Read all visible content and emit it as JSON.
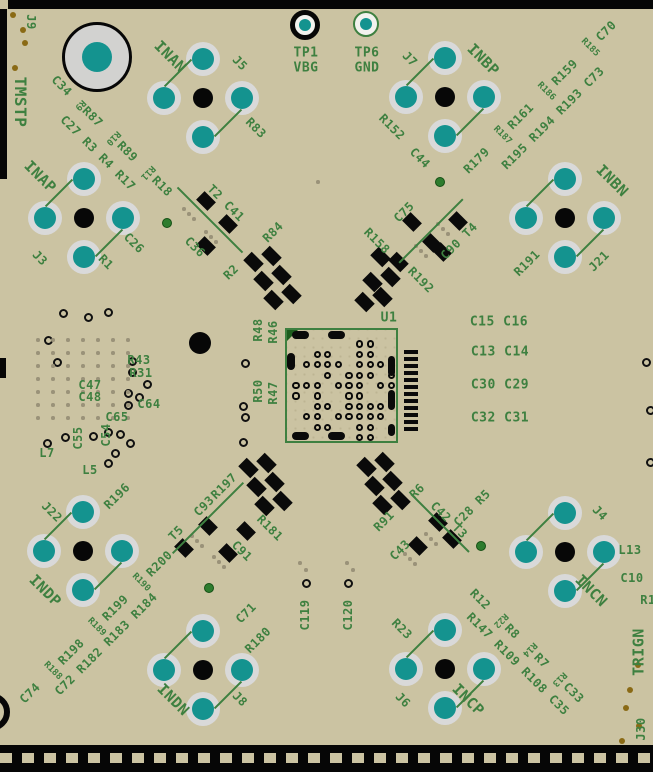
{
  "view": {
    "width": 653,
    "height": 772,
    "description": "PCB layout top view"
  },
  "colors": {
    "board_tan": "#cbc3a2",
    "silkscreen_green": "#3e8040",
    "pad_teal": "#14938f",
    "pad_ring_gray": "#d9d9d9",
    "background_black": "#060606",
    "gold_dot": "#8a6a15",
    "via_green": "#2e7c2e"
  },
  "big_pad": {
    "label": "1",
    "cx": 97,
    "cy": 57,
    "r": 35
  },
  "testpoints": [
    {
      "name": "TP1",
      "net": "VBG",
      "cx": 305,
      "cy": 25,
      "ring_color": "#070707",
      "ring_w": 5,
      "r": 15
    },
    {
      "name": "TP6",
      "net": "GND",
      "cx": 366,
      "cy": 24,
      "ring_color": "#3e8040",
      "ring_w": 2,
      "r": 13
    }
  ],
  "connectors": [
    {
      "net": "INAN",
      "refdes": "J5",
      "cx": 203,
      "cy": 98
    },
    {
      "net": "INBP",
      "refdes": "J7",
      "cx": 445,
      "cy": 97
    },
    {
      "net": "INAP",
      "refdes": "J3",
      "cx": 84,
      "cy": 218
    },
    {
      "net": "INBN",
      "refdes": "J21",
      "cx": 565,
      "cy": 218
    },
    {
      "net": "INDP",
      "refdes": "J22",
      "cx": 83,
      "cy": 551
    },
    {
      "net": "INDN",
      "refdes": "J8",
      "cx": 203,
      "cy": 670
    },
    {
      "net": "INCN",
      "refdes": "J4",
      "cx": 565,
      "cy": 552
    },
    {
      "net": "INCP",
      "refdes": "J6",
      "cx": 445,
      "cy": 669
    }
  ],
  "chip": {
    "refdes": "U1",
    "x": 285,
    "y": 328,
    "w": 113,
    "h": 115,
    "bga_rows": [
      "......OO..",
      "..OO..OO..",
      ".OOOO.OOO.",
      "...O.OOO.O",
      "OOO.OOO.OO",
      "O.O..OO..O",
      "..OO.OOOO.",
      ".OO.OOOOO.",
      "..OO..OO..",
      "......OO.."
    ],
    "bga_x0": 296,
    "bga_y0": 344,
    "bga_dx": 10.6,
    "bga_dy": 10.4
  },
  "ovals": [
    [
      300,
      335,
      17,
      8
    ],
    [
      336,
      335,
      17,
      8
    ],
    [
      300,
      436,
      17,
      8
    ],
    [
      336,
      436,
      17,
      8
    ],
    [
      291,
      361,
      8,
      17
    ],
    [
      391,
      366,
      7,
      20
    ],
    [
      391,
      400,
      7,
      20
    ],
    [
      391,
      430,
      7,
      12
    ]
  ],
  "bars": {
    "x": 404,
    "y0": 350,
    "count": 12,
    "step": 7,
    "w": 14,
    "h": 4
  },
  "labels": [
    {
      "t": "J9",
      "x": 31,
      "y": 22,
      "r": 90,
      "s": 12
    },
    {
      "t": "TMSTP",
      "x": 20,
      "y": 102,
      "r": 90,
      "s": 16
    },
    {
      "t": "TP1",
      "x": 306,
      "y": 53,
      "r": 0,
      "s": 13
    },
    {
      "t": "VBG",
      "x": 306,
      "y": 68,
      "r": 0,
      "s": 13
    },
    {
      "t": "TP6",
      "x": 367,
      "y": 53,
      "r": 0,
      "s": 13
    },
    {
      "t": "GND",
      "x": 367,
      "y": 68,
      "r": 0,
      "s": 13
    },
    {
      "t": "INAN",
      "x": 170,
      "y": 57,
      "r": 45,
      "s": 15
    },
    {
      "t": "J5",
      "x": 240,
      "y": 63,
      "r": 45,
      "s": 12
    },
    {
      "t": "R83",
      "x": 256,
      "y": 128,
      "r": 45,
      "s": 12
    },
    {
      "t": "J7",
      "x": 410,
      "y": 59,
      "r": 45,
      "s": 12
    },
    {
      "t": "INBP",
      "x": 483,
      "y": 60,
      "r": 45,
      "s": 15
    },
    {
      "t": "R152",
      "x": 392,
      "y": 127,
      "r": 45,
      "s": 12
    },
    {
      "t": "C44",
      "x": 420,
      "y": 158,
      "r": 45,
      "s": 12
    },
    {
      "t": "INAP",
      "x": 40,
      "y": 177,
      "r": 45,
      "s": 15
    },
    {
      "t": "J3",
      "x": 40,
      "y": 258,
      "r": 45,
      "s": 12
    },
    {
      "t": "R1",
      "x": 106,
      "y": 262,
      "r": 45,
      "s": 12
    },
    {
      "t": "C26",
      "x": 134,
      "y": 243,
      "r": 45,
      "s": 12
    },
    {
      "t": "INBN",
      "x": 612,
      "y": 181,
      "r": 45,
      "s": 15
    },
    {
      "t": "J21",
      "x": 599,
      "y": 261,
      "r": -45,
      "s": 12
    },
    {
      "t": "R191",
      "x": 527,
      "y": 263,
      "r": -45,
      "s": 12
    },
    {
      "t": "J22",
      "x": 52,
      "y": 512,
      "r": 45,
      "s": 12
    },
    {
      "t": "R196",
      "x": 117,
      "y": 496,
      "r": -45,
      "s": 12
    },
    {
      "t": "INDP",
      "x": 45,
      "y": 591,
      "r": 45,
      "s": 15
    },
    {
      "t": "C71",
      "x": 246,
      "y": 613,
      "r": -45,
      "s": 12
    },
    {
      "t": "R180",
      "x": 258,
      "y": 640,
      "r": -45,
      "s": 12
    },
    {
      "t": "INDN",
      "x": 173,
      "y": 700,
      "r": 45,
      "s": 15
    },
    {
      "t": "J8",
      "x": 240,
      "y": 699,
      "r": 45,
      "s": 12
    },
    {
      "t": "C28 R5",
      "x": 472,
      "y": 508,
      "r": -45,
      "s": 12
    },
    {
      "t": "J4",
      "x": 600,
      "y": 513,
      "r": 45,
      "s": 12
    },
    {
      "t": "INCN",
      "x": 591,
      "y": 591,
      "r": 45,
      "s": 15
    },
    {
      "t": "L13",
      "x": 630,
      "y": 550,
      "r": 0,
      "s": 12
    },
    {
      "t": "C10",
      "x": 632,
      "y": 578,
      "r": 0,
      "s": 12
    },
    {
      "t": "R1",
      "x": 648,
      "y": 600,
      "r": 0,
      "s": 12
    },
    {
      "t": "R23",
      "x": 402,
      "y": 629,
      "r": 45,
      "s": 12
    },
    {
      "t": "J6",
      "x": 403,
      "y": 700,
      "r": 45,
      "s": 12
    },
    {
      "t": "INCP",
      "x": 468,
      "y": 700,
      "r": 45,
      "s": 15
    },
    {
      "t": "TRIGN",
      "x": 639,
      "y": 652,
      "r": -90,
      "s": 15
    },
    {
      "t": "J30",
      "x": 641,
      "y": 729,
      "r": -90,
      "s": 12
    },
    {
      "t": "T2 C41",
      "x": 226,
      "y": 203,
      "r": 45,
      "s": 12
    },
    {
      "t": "C36",
      "x": 195,
      "y": 247,
      "r": 45,
      "s": 12
    },
    {
      "t": "R84",
      "x": 273,
      "y": 232,
      "r": -45,
      "s": 12
    },
    {
      "t": "R2",
      "x": 231,
      "y": 272,
      "r": -45,
      "s": 12
    },
    {
      "t": "C75",
      "x": 404,
      "y": 212,
      "r": -45,
      "s": 12
    },
    {
      "t": "R158",
      "x": 377,
      "y": 241,
      "r": 45,
      "s": 12
    },
    {
      "t": "R192",
      "x": 421,
      "y": 280,
      "r": 45,
      "s": 12
    },
    {
      "t": "C90 T4",
      "x": 459,
      "y": 241,
      "r": -45,
      "s": 12
    },
    {
      "t": "R197",
      "x": 224,
      "y": 486,
      "r": -45,
      "s": 12
    },
    {
      "t": "C93",
      "x": 204,
      "y": 506,
      "r": -45,
      "s": 12
    },
    {
      "t": "T5",
      "x": 176,
      "y": 533,
      "r": -45,
      "s": 12
    },
    {
      "t": "R181",
      "x": 270,
      "y": 528,
      "r": 45,
      "s": 12
    },
    {
      "t": "C91",
      "x": 242,
      "y": 551,
      "r": 45,
      "s": 12
    },
    {
      "t": "R91",
      "x": 384,
      "y": 521,
      "r": -45,
      "s": 12
    },
    {
      "t": "R6",
      "x": 417,
      "y": 491,
      "r": -45,
      "s": 12
    },
    {
      "t": "C42 T3",
      "x": 449,
      "y": 520,
      "r": 45,
      "s": 12
    },
    {
      "t": "C43",
      "x": 400,
      "y": 550,
      "r": -45,
      "s": 12
    },
    {
      "t": "U1",
      "x": 389,
      "y": 318,
      "r": 0,
      "s": 13
    },
    {
      "t": "R48",
      "x": 258,
      "y": 330,
      "r": -90,
      "s": 12
    },
    {
      "t": "R46",
      "x": 273,
      "y": 332,
      "r": -90,
      "s": 12
    },
    {
      "t": "R50",
      "x": 258,
      "y": 391,
      "r": -90,
      "s": 12
    },
    {
      "t": "R47",
      "x": 273,
      "y": 393,
      "r": -90,
      "s": 12
    },
    {
      "t": "C15 C16",
      "x": 499,
      "y": 322,
      "r": 0,
      "s": 13
    },
    {
      "t": "C13 C14",
      "x": 500,
      "y": 352,
      "r": 0,
      "s": 13
    },
    {
      "t": "C30 C29",
      "x": 500,
      "y": 385,
      "r": 0,
      "s": 13
    },
    {
      "t": "C32 C31",
      "x": 500,
      "y": 418,
      "r": 0,
      "s": 13
    },
    {
      "t": "R43",
      "x": 139,
      "y": 360,
      "r": 0,
      "s": 12
    },
    {
      "t": "R31",
      "x": 141,
      "y": 373,
      "r": 0,
      "s": 12
    },
    {
      "t": "C47",
      "x": 90,
      "y": 385,
      "r": 0,
      "s": 12
    },
    {
      "t": "C48",
      "x": 90,
      "y": 397,
      "r": 0,
      "s": 12
    },
    {
      "t": "C64",
      "x": 149,
      "y": 404,
      "r": 0,
      "s": 12
    },
    {
      "t": "C65",
      "x": 117,
      "y": 417,
      "r": 0,
      "s": 12
    },
    {
      "t": "C54",
      "x": 106,
      "y": 435,
      "r": -90,
      "s": 12
    },
    {
      "t": "C55",
      "x": 78,
      "y": 438,
      "r": -90,
      "s": 12
    },
    {
      "t": "L7",
      "x": 47,
      "y": 453,
      "r": 0,
      "s": 12
    },
    {
      "t": "L5",
      "x": 90,
      "y": 470,
      "r": 0,
      "s": 12
    },
    {
      "t": "C119",
      "x": 305,
      "y": 615,
      "r": -90,
      "s": 12
    },
    {
      "t": "C120",
      "x": 348,
      "y": 615,
      "r": -90,
      "s": 12
    },
    {
      "segs": [
        {
          "t": "C34 "
        },
        {
          "t": "R9",
          "perp": true
        },
        {
          "t": "R87 "
        },
        {
          "t": "R10",
          "perp": true
        },
        {
          "t": "R89 "
        },
        {
          "t": "R11",
          "perp": true
        },
        {
          "t": "R18"
        }
      ],
      "x": 112,
      "y": 136,
      "r": 45,
      "s": 12
    },
    {
      "t": "C27  R3   R4   R17",
      "x": 98,
      "y": 153,
      "r": 45,
      "s": 12
    },
    {
      "segs": [
        {
          "t": "R179 "
        },
        {
          "t": "R187",
          "perp": true
        },
        {
          "t": "R161 "
        },
        {
          "t": "R186",
          "perp": true
        },
        {
          "t": "R159 "
        },
        {
          "t": "R185",
          "perp": true
        },
        {
          "t": "C70"
        }
      ],
      "x": 540,
      "y": 97,
      "r": -45,
      "s": 12
    },
    {
      "t": "R195  R194  R193  C73",
      "x": 553,
      "y": 118,
      "r": -45,
      "s": 12
    },
    {
      "segs": [
        {
          "t": "C74 "
        },
        {
          "t": "R188",
          "perp": true
        },
        {
          "t": "R198 "
        },
        {
          "t": "R189",
          "perp": true
        },
        {
          "t": "R199 "
        },
        {
          "t": "R190",
          "perp": true
        },
        {
          "t": "R200"
        }
      ],
      "x": 96,
      "y": 627,
      "r": -45,
      "s": 12
    },
    {
      "t": "C72  R182  R183  R184",
      "x": 106,
      "y": 644,
      "r": -45,
      "s": 12
    },
    {
      "segs": [
        {
          "t": "R12 "
        },
        {
          "t": "R22",
          "perp": true
        },
        {
          "t": "R8 "
        },
        {
          "t": "R14",
          "perp": true
        },
        {
          "t": "R7 "
        },
        {
          "t": "R13",
          "perp": true
        },
        {
          "t": "C33"
        }
      ],
      "x": 527,
      "y": 646,
      "r": 45,
      "s": 12
    },
    {
      "t": "R147  R109  R108  C35",
      "x": 518,
      "y": 664,
      "r": 45,
      "s": 12
    }
  ],
  "smd_pads": [
    [
      206,
      201,
      16,
      12
    ],
    [
      228,
      224,
      16,
      12
    ],
    [
      206,
      246,
      16,
      12
    ],
    [
      253,
      262,
      17,
      12
    ],
    [
      271,
      256,
      17,
      12
    ],
    [
      263,
      281,
      17,
      12
    ],
    [
      281,
      275,
      17,
      12
    ],
    [
      273,
      300,
      17,
      12
    ],
    [
      291,
      294,
      17,
      12
    ],
    [
      412,
      222,
      16,
      12
    ],
    [
      432,
      243,
      16,
      12
    ],
    [
      458,
      221,
      16,
      12
    ],
    [
      442,
      252,
      16,
      12
    ],
    [
      398,
      262,
      17,
      12
    ],
    [
      380,
      257,
      17,
      12
    ],
    [
      390,
      277,
      17,
      12
    ],
    [
      372,
      282,
      17,
      12
    ],
    [
      382,
      297,
      17,
      12
    ],
    [
      364,
      302,
      17,
      12
    ],
    [
      208,
      526,
      16,
      12
    ],
    [
      184,
      548,
      16,
      12
    ],
    [
      228,
      553,
      16,
      12
    ],
    [
      246,
      531,
      16,
      12
    ],
    [
      248,
      468,
      17,
      12
    ],
    [
      266,
      463,
      17,
      12
    ],
    [
      256,
      487,
      17,
      12
    ],
    [
      274,
      482,
      17,
      12
    ],
    [
      264,
      506,
      17,
      12
    ],
    [
      282,
      501,
      17,
      12
    ],
    [
      438,
      522,
      16,
      12
    ],
    [
      418,
      546,
      16,
      12
    ],
    [
      452,
      539,
      16,
      12
    ],
    [
      366,
      467,
      17,
      12
    ],
    [
      384,
      462,
      17,
      12
    ],
    [
      374,
      486,
      17,
      12
    ],
    [
      392,
      481,
      17,
      12
    ],
    [
      382,
      505,
      17,
      12
    ],
    [
      400,
      500,
      17,
      12
    ]
  ],
  "cluster_lines": [
    [
      210,
      220,
      92,
      45
    ],
    [
      431,
      231,
      90,
      -45
    ],
    [
      208,
      518,
      100,
      -45
    ],
    [
      440,
      523,
      82,
      45
    ]
  ],
  "vias": [
    [
      63,
      313
    ],
    [
      88,
      317
    ],
    [
      108,
      312
    ],
    [
      48,
      340
    ],
    [
      57,
      362
    ],
    [
      132,
      361
    ],
    [
      132,
      372
    ],
    [
      147,
      384
    ],
    [
      128,
      393
    ],
    [
      139,
      397
    ],
    [
      128,
      405
    ],
    [
      65,
      437
    ],
    [
      47,
      443
    ],
    [
      93,
      436
    ],
    [
      108,
      432
    ],
    [
      120,
      434
    ],
    [
      115,
      453
    ],
    [
      108,
      463
    ],
    [
      130,
      443
    ],
    [
      245,
      363
    ],
    [
      243,
      406
    ],
    [
      245,
      417
    ],
    [
      243,
      442
    ],
    [
      646,
      362
    ],
    [
      650,
      410
    ],
    [
      650,
      462
    ],
    [
      306,
      583
    ],
    [
      348,
      583
    ]
  ],
  "big_via": {
    "cx": 200,
    "cy": 343,
    "r": 11
  },
  "green_vias": [
    [
      167,
      223
    ],
    [
      440,
      182
    ],
    [
      209,
      588
    ],
    [
      481,
      546
    ]
  ],
  "gold_dots": [
    [
      13,
      15
    ],
    [
      23,
      30
    ],
    [
      25,
      43
    ],
    [
      15,
      68
    ],
    [
      638,
      665
    ],
    [
      630,
      690
    ],
    [
      626,
      708
    ],
    [
      639,
      726
    ],
    [
      622,
      741
    ]
  ],
  "dot_triplets": [
    [
      189,
      214
    ],
    [
      211,
      237
    ],
    [
      421,
      251
    ],
    [
      443,
      229
    ],
    [
      197,
      541
    ],
    [
      219,
      562
    ],
    [
      431,
      539
    ],
    [
      410,
      559
    ]
  ],
  "misc_dots": [
    [
      300,
      563
    ],
    [
      306,
      570
    ],
    [
      347,
      563
    ],
    [
      353,
      570
    ],
    [
      318,
      182
    ]
  ],
  "dot_grid": {
    "x": 38,
    "y": 340,
    "cols": 7,
    "rows": 7,
    "dx": 15,
    "dy": 13
  },
  "edges": {
    "top_strip": [
      8,
      0,
      645,
      9
    ],
    "left_sliver": [
      0,
      9,
      7,
      170
    ],
    "left_tab": [
      0,
      358,
      6,
      20
    ],
    "bottom_strip": [
      0,
      745,
      653,
      27
    ],
    "dashes": {
      "x": 0,
      "y": 753,
      "w": 653,
      "h": 10
    },
    "bl_circle": {
      "left": -28,
      "top": 693,
      "size": 38
    }
  }
}
